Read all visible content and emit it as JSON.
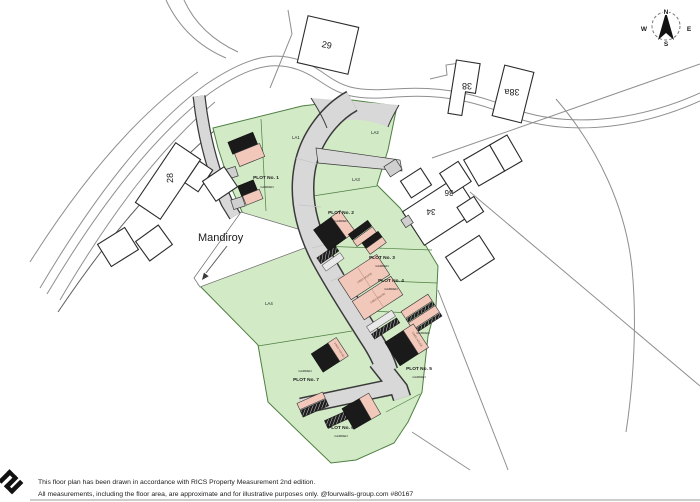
{
  "colors": {
    "green_fill": "#d2eac6",
    "green_stroke": "#4e7f41",
    "road_fill": "#d8d8d8",
    "road_stroke": "#3a3a3a",
    "building_dark": "#1a1a1a",
    "building_pink": "#f1c8b9",
    "line_gray": "#8f8f8f"
  },
  "compass": {
    "n": "N",
    "e": "E",
    "s": "S",
    "w": "W"
  },
  "plan": {
    "street_name": "Mandiroy",
    "la": {
      "la1": "LA1",
      "la2": "LA2",
      "la3": "LA3",
      "la4": "LA4"
    },
    "plots": [
      {
        "label": "PLOT No. 1",
        "garden": "GARDEN"
      },
      {
        "label": "PLOT No. 2",
        "garden": "GARDEN"
      },
      {
        "label": "PLOT No. 3",
        "garden": "GARDEN"
      },
      {
        "label": "PLOT No. 4",
        "garden": "GARDEN"
      },
      {
        "label": "PLOT No. 5",
        "garden": "GARDEN"
      },
      {
        "label": "PLOT No. 6",
        "garden": "GARDEN"
      },
      {
        "label": "PLOT No. 7",
        "garden": "GARDEN"
      }
    ],
    "extra_garden": "GARDEN",
    "house_type": "3 BED HOUSE",
    "houses": {
      "h29": "29",
      "h28": "28",
      "h38": "38",
      "h38a": "38a",
      "h36": "36",
      "h34": "34"
    }
  },
  "footer": {
    "line1": "This floor plan has been drawn in accordance with RICS Property Measurement 2nd edition.",
    "line2": "All measurements, including the floor area, are approximate and for illustrative purposes only. @fourwalls-group.com #80167"
  }
}
